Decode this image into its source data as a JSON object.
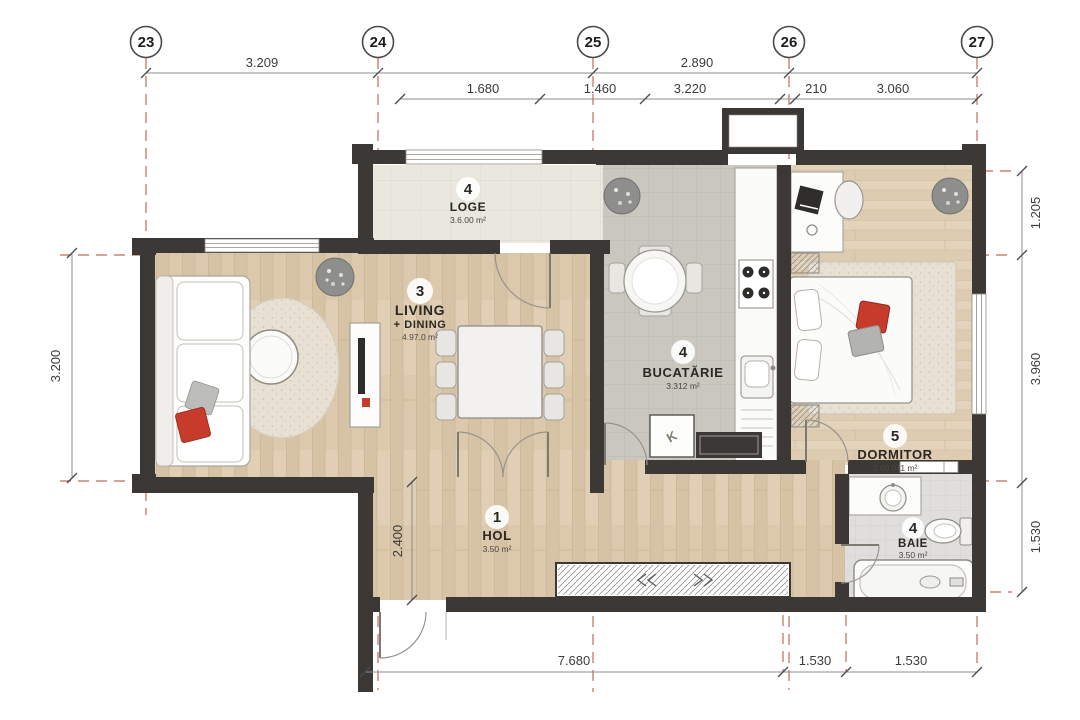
{
  "title": "Apartment floor plan",
  "grid": {
    "columns": [
      {
        "label": "23"
      },
      {
        "label": "24"
      },
      {
        "label": "25"
      },
      {
        "label": "26"
      },
      {
        "label": "27"
      }
    ]
  },
  "dimensions": {
    "top_row1": [
      "3.209",
      "2.890"
    ],
    "top_row2": [
      "1.680",
      "1.460",
      "3.220",
      "210",
      "3.060"
    ],
    "left": [
      "3.200"
    ],
    "right": [
      "1.205",
      "3.960",
      "1.530"
    ],
    "bottom": [
      "7.680",
      "1.530",
      "1.530"
    ],
    "interior": [
      "2.400"
    ]
  },
  "rooms": [
    {
      "number": "4",
      "name": "LOGE",
      "area": "3.6.00 m²"
    },
    {
      "number": "3",
      "name": "LIVING",
      "name2": "+ DINING",
      "area": "4.97.0 m²"
    },
    {
      "number": "4",
      "name": "BUCATĂRIE",
      "area": "3.312 m²"
    },
    {
      "number": "5",
      "name": "DORMITOR",
      "area": "3.00.011 m²"
    },
    {
      "number": "1",
      "name": "HOL",
      "area": "3.50 m²"
    },
    {
      "number": "4",
      "name": "BAIE",
      "area": "3.50 m²"
    }
  ],
  "fixtures": {
    "kitchen_unit_label": "K"
  },
  "colors": {
    "wall": "#3c3835",
    "grid_red": "#b5523c",
    "accent_red": "#c63b2a",
    "wood_floor": "#dcc9ad",
    "kitchen_tile": "#cac7c1",
    "loge_tile": "#eae7de",
    "bath_tile": "#dfdedc"
  }
}
